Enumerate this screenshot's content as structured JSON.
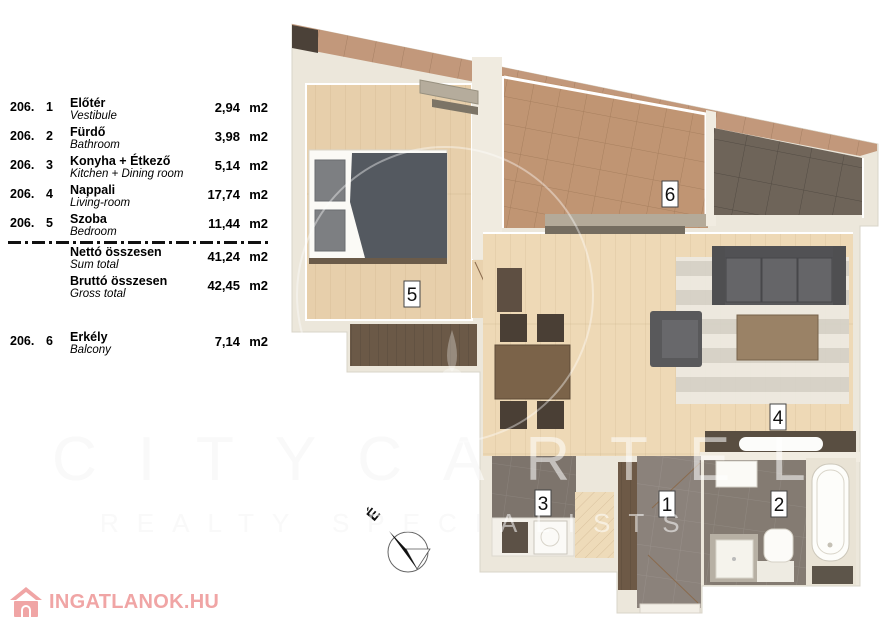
{
  "legend": {
    "rows": [
      {
        "code": "206.",
        "idx": "1",
        "name_hu": "Előtér",
        "name_en": "Vestibule",
        "value": "2,94",
        "unit": "m2"
      },
      {
        "code": "206.",
        "idx": "2",
        "name_hu": "Fürdő",
        "name_en": "Bathroom",
        "value": "3,98",
        "unit": "m2"
      },
      {
        "code": "206.",
        "idx": "3",
        "name_hu": "Konyha + Étkező",
        "name_en": "Kitchen + Dining room",
        "value": "5,14",
        "unit": "m2"
      },
      {
        "code": "206.",
        "idx": "4",
        "name_hu": "Nappali",
        "name_en": "Living-room",
        "value": "17,74",
        "unit": "m2"
      },
      {
        "code": "206.",
        "idx": "5",
        "name_hu": "Szoba",
        "name_en": "Bedroom",
        "value": "11,44",
        "unit": "m2"
      }
    ],
    "totals": [
      {
        "name_hu": "Nettó összesen",
        "name_en": "Sum total",
        "value": "41,24",
        "unit": "m2"
      },
      {
        "name_hu": "Bruttó összesen",
        "name_en": "Gross total",
        "value": "42,45",
        "unit": "m2"
      }
    ],
    "balcony_row": {
      "code": "206.",
      "idx": "6",
      "name_hu": "Erkély",
      "name_en": "Balcony",
      "value": "7,14",
      "unit": "m2"
    }
  },
  "plan": {
    "labels": [
      "5",
      "6",
      "4",
      "3",
      "1",
      "2"
    ],
    "compass_label": "É"
  },
  "watermark": {
    "line1": "CITYCARTEL",
    "line2": "REALTY SPECIALISTS"
  },
  "logo": {
    "text": "INGATLANOK.HU",
    "color": "#f0a5a5"
  }
}
